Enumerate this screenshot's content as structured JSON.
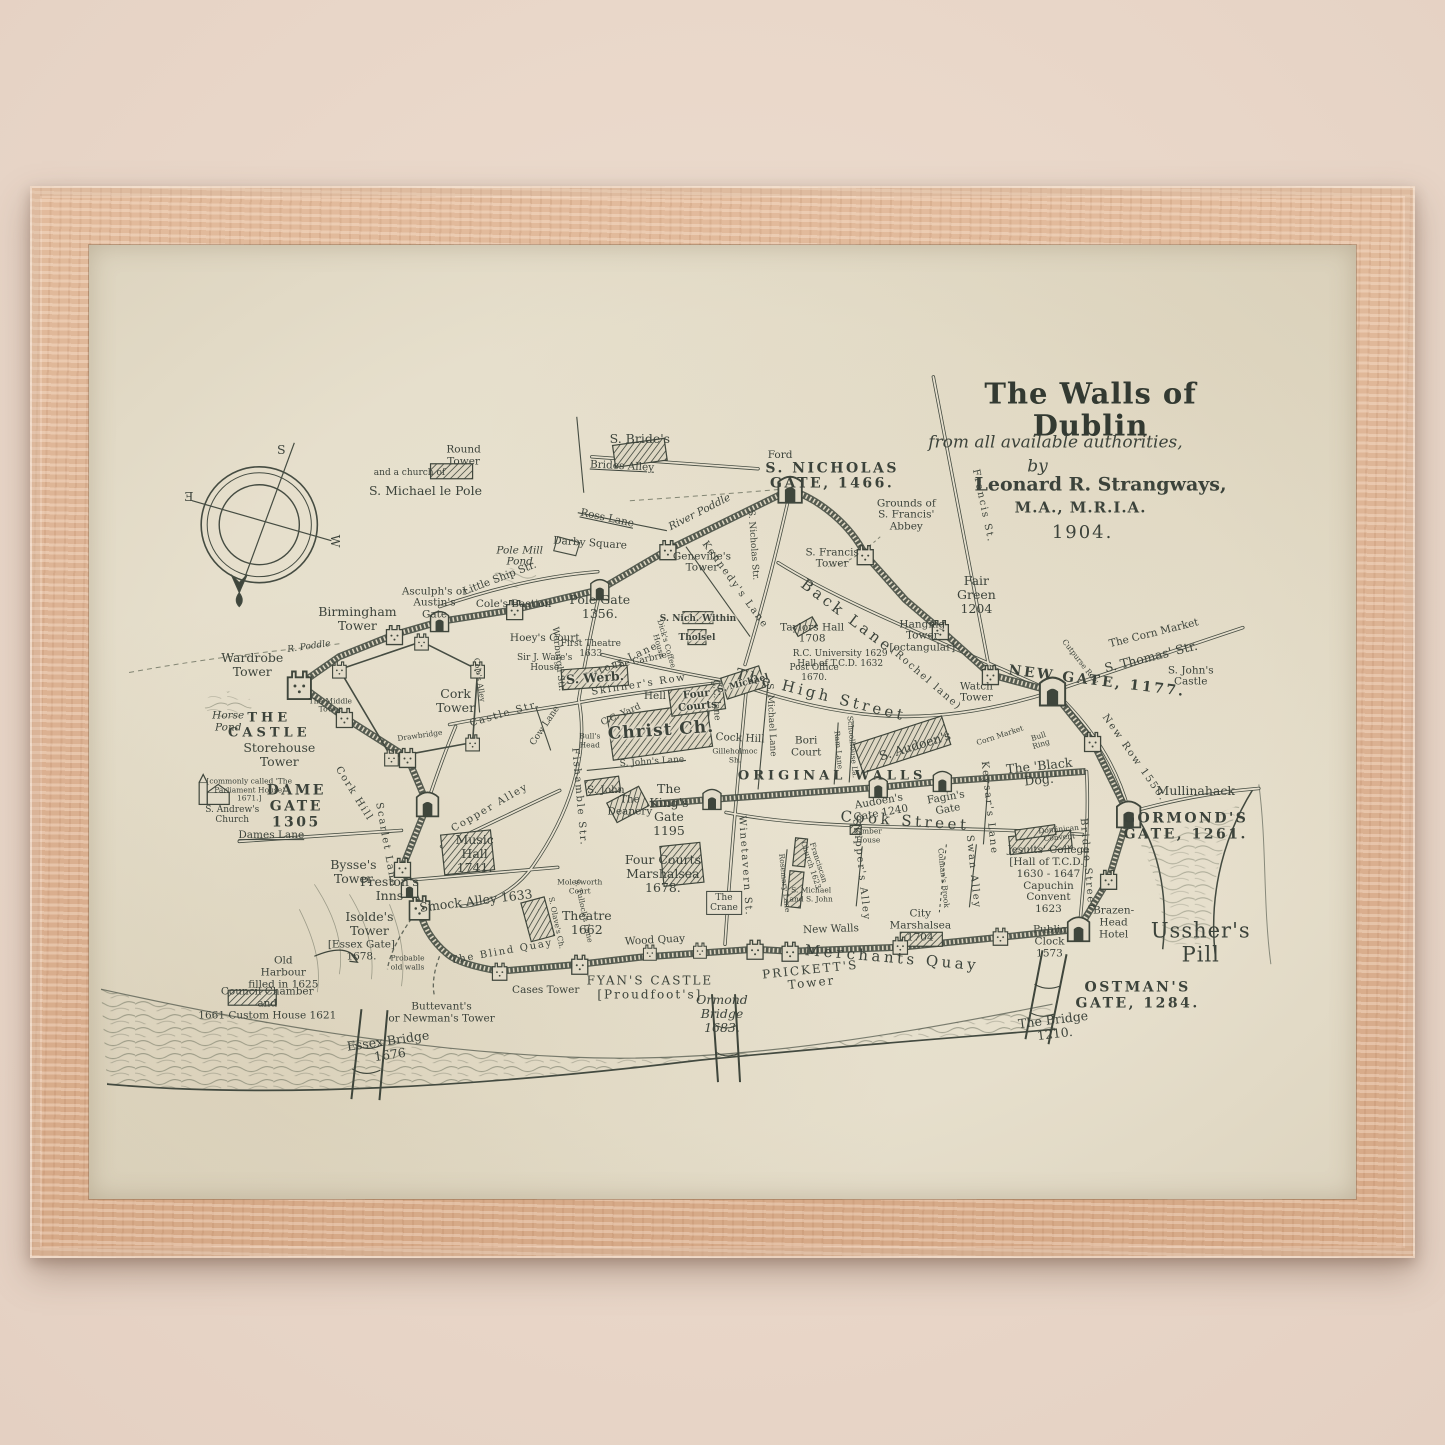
{
  "artwork": {
    "kind": "framed antique map print",
    "frame_color": "#dcb293",
    "paper_color": "#e6dfcc",
    "ink_color": "#3c433b"
  },
  "map": {
    "title": {
      "main": "The Walls of Dublin",
      "sub": "from all available authorities,",
      "by": "by",
      "author": "Leonard R. Strangways,",
      "credentials": "M.A., M.R.I.A.",
      "year": "1904."
    },
    "compass": {
      "letters": [
        "S",
        "Ǝ",
        "W"
      ]
    },
    "labels": [
      {
        "t": "S",
        "x": 192,
        "y": 205,
        "c": "med"
      },
      {
        "t": "Ǝ",
        "x": 100,
        "y": 252,
        "c": "med"
      },
      {
        "t": "W",
        "x": 246,
        "y": 296,
        "c": "med",
        "r": 90
      },
      {
        "t": "Round\nTower",
        "x": 374,
        "y": 211,
        "c": "sm"
      },
      {
        "t": "and a church of",
        "x": 320,
        "y": 228,
        "c": "tiny"
      },
      {
        "t": "S. Michael le Pole",
        "x": 336,
        "y": 246,
        "c": "med"
      },
      {
        "t": "S. Bride's",
        "x": 550,
        "y": 194,
        "c": "med"
      },
      {
        "t": "Brides Alley",
        "x": 532,
        "y": 222,
        "c": "sm ul",
        "r": 3
      },
      {
        "t": "Ross Lane",
        "x": 517,
        "y": 274,
        "c": "sm ul",
        "r": 12
      },
      {
        "t": "River Poddle",
        "x": 610,
        "y": 268,
        "c": "sm water",
        "r": -27
      },
      {
        "t": "Darby Square",
        "x": 500,
        "y": 299,
        "c": "sm",
        "r": 4
      },
      {
        "t": "Geneville's\nTower",
        "x": 612,
        "y": 318,
        "c": "sm"
      },
      {
        "t": "Ford",
        "x": 690,
        "y": 211,
        "c": "sm"
      },
      {
        "t": "S. NICHOLAS\nGATE, 1466.",
        "x": 742,
        "y": 232,
        "c": "gate"
      },
      {
        "t": "Grounds of\nS. Francis'\nAbbey",
        "x": 816,
        "y": 271,
        "c": "sm"
      },
      {
        "t": "S. Francis\nTower",
        "x": 742,
        "y": 314,
        "c": "sm"
      },
      {
        "t": "Fair\nGreen\n1204",
        "x": 886,
        "y": 350,
        "c": "med"
      },
      {
        "t": "Francis St.",
        "x": 893,
        "y": 261,
        "c": "street",
        "r": 78
      },
      {
        "t": "Pole Mill\nPond",
        "x": 430,
        "y": 312,
        "c": "sm water"
      },
      {
        "t": "Little Ship Str.",
        "x": 410,
        "y": 334,
        "c": "sm",
        "r": -21
      },
      {
        "t": "Asculph's or\nAustin's\nGate",
        "x": 345,
        "y": 359,
        "c": "sm"
      },
      {
        "t": "Cole's Bastion",
        "x": 424,
        "y": 360,
        "c": "sm"
      },
      {
        "t": "Birmingham\nTower",
        "x": 268,
        "y": 374,
        "c": "med"
      },
      {
        "t": "R. Poddle",
        "x": 220,
        "y": 402,
        "c": "tiny water",
        "r": -8
      },
      {
        "t": "Pole Gate\n1356.",
        "x": 510,
        "y": 362,
        "c": "med"
      },
      {
        "t": "Hoey's Court",
        "x": 455,
        "y": 394,
        "c": "sm"
      },
      {
        "t": "First Theatre\n1633",
        "x": 501,
        "y": 404,
        "c": "tiny"
      },
      {
        "t": "Sutors Lane",
        "x": 531,
        "y": 417,
        "c": "street",
        "r": -24
      },
      {
        "t": "Sir J. Ware's\nHouse",
        "x": 455,
        "y": 418,
        "c": "tiny"
      },
      {
        "t": "S. Werb.",
        "x": 505,
        "y": 433,
        "c": "med onhatch",
        "r": -4
      },
      {
        "t": "Werburgh Str.",
        "x": 468,
        "y": 414,
        "c": "tiny",
        "r": 84
      },
      {
        "t": "Cole's Alley",
        "x": 389,
        "y": 435,
        "c": "micro",
        "r": 82
      },
      {
        "t": "Cow Lane",
        "x": 455,
        "y": 482,
        "c": "tiny",
        "r": -56
      },
      {
        "t": "Castle Str.",
        "x": 415,
        "y": 469,
        "c": "street",
        "r": -16
      },
      {
        "t": "Drawbridge",
        "x": 330,
        "y": 492,
        "c": "micro",
        "r": -8
      },
      {
        "t": "Wardrobe\nTower",
        "x": 163,
        "y": 420,
        "c": "med"
      },
      {
        "t": "THE\nCASTLE",
        "x": 180,
        "y": 482,
        "c": "caps"
      },
      {
        "t": "The Middle\nTower",
        "x": 241,
        "y": 461,
        "c": "micro"
      },
      {
        "t": "Cork\nTower",
        "x": 366,
        "y": 456,
        "c": "med"
      },
      {
        "t": "Horse\nPond",
        "x": 139,
        "y": 478,
        "c": "sm water"
      },
      {
        "t": "Storehouse\nTower",
        "x": 190,
        "y": 511,
        "c": "med"
      },
      {
        "t": "[commonly called 'The\nParliament House'\n1671.]",
        "x": 160,
        "y": 546,
        "c": "micro"
      },
      {
        "t": "DAME\nGATE\n1305",
        "x": 207,
        "y": 563,
        "c": "gate"
      },
      {
        "t": "S. Andrew's\nChurch",
        "x": 143,
        "y": 571,
        "c": "tiny"
      },
      {
        "t": "Dames Lane",
        "x": 182,
        "y": 592,
        "c": "sm ul"
      },
      {
        "t": "Cork Hill",
        "x": 265,
        "y": 550,
        "c": "street",
        "r": 58
      },
      {
        "t": "Scarlet Lane",
        "x": 297,
        "y": 601,
        "c": "street",
        "r": 80
      },
      {
        "t": "Bysse's\nTower",
        "x": 264,
        "y": 628,
        "c": "med"
      },
      {
        "t": "Isolde's\nTower",
        "x": 280,
        "y": 680,
        "c": "med"
      },
      {
        "t": "[Essex Gate]\n1678.",
        "x": 272,
        "y": 707,
        "c": "sm"
      },
      {
        "t": "Preston's\nInns",
        "x": 300,
        "y": 645,
        "c": "med"
      },
      {
        "t": "Smock Alley 1633",
        "x": 386,
        "y": 657,
        "c": "med",
        "r": -7
      },
      {
        "t": "Copper Alley",
        "x": 400,
        "y": 564,
        "c": "street",
        "r": -30
      },
      {
        "t": "Music\nHall\n1741.",
        "x": 385,
        "y": 610,
        "c": "med"
      },
      {
        "t": "Fishamble Str.",
        "x": 489,
        "y": 553,
        "c": "street",
        "r": 85
      },
      {
        "t": "Molesworth\nCourt",
        "x": 490,
        "y": 643,
        "c": "micro"
      },
      {
        "t": "S. Olave's Ch.",
        "x": 466,
        "y": 679,
        "c": "micro",
        "r": 78
      },
      {
        "t": "S. Tullock's Lane",
        "x": 493,
        "y": 667,
        "c": "micro",
        "r": 78
      },
      {
        "t": "Theatre\n1662",
        "x": 497,
        "y": 679,
        "c": "med"
      },
      {
        "t": "The Blind Quay",
        "x": 412,
        "y": 708,
        "c": "street",
        "r": -10
      },
      {
        "t": "Probable\nold walls",
        "x": 318,
        "y": 719,
        "c": "micro"
      },
      {
        "t": "Cases Tower",
        "x": 456,
        "y": 747,
        "c": "sm"
      },
      {
        "t": "Wood Quay",
        "x": 565,
        "y": 697,
        "c": "sm",
        "r": -3
      },
      {
        "t": "FYAN'S CASTLE\n[Proudfoot's]",
        "x": 560,
        "y": 744,
        "c": "gate2"
      },
      {
        "t": "Ormond\nBridge\n1683.",
        "x": 632,
        "y": 770,
        "c": "med script2"
      },
      {
        "t": "PRICKETT'S\nTower",
        "x": 721,
        "y": 733,
        "c": "gate2",
        "r": -6
      },
      {
        "t": "New Walls",
        "x": 741,
        "y": 686,
        "c": "sm",
        "r": -2
      },
      {
        "t": "Merchants Quay",
        "x": 802,
        "y": 714,
        "c": "street2",
        "r": 5
      },
      {
        "t": "The\nCrane",
        "x": 634,
        "y": 659,
        "c": "tiny boxed"
      },
      {
        "t": "Winetavern St.",
        "x": 655,
        "y": 622,
        "c": "street",
        "r": 86
      },
      {
        "t": "Rosemary Lane",
        "x": 694,
        "y": 639,
        "c": "micro",
        "r": 84
      },
      {
        "t": "S. Michael\nand S. John",
        "x": 721,
        "y": 651,
        "c": "micro"
      },
      {
        "t": "Franciscan\nChurch 1623",
        "x": 724,
        "y": 620,
        "c": "micro",
        "r": 72
      },
      {
        "t": "Skipper's Alley",
        "x": 771,
        "y": 626,
        "c": "street",
        "r": 84
      },
      {
        "t": "Colman's Brook",
        "x": 853,
        "y": 634,
        "c": "micro",
        "r": 84
      },
      {
        "t": "Swan Alley",
        "x": 883,
        "y": 628,
        "c": "street",
        "r": 84
      },
      {
        "t": "City\nMarshalsea\n1704",
        "x": 830,
        "y": 682,
        "c": "sm"
      },
      {
        "t": "Cook Street",
        "x": 815,
        "y": 577,
        "c": "street2",
        "r": 4
      },
      {
        "t": "Audoen's\nGate 1240",
        "x": 790,
        "y": 564,
        "c": "sm",
        "r": -10
      },
      {
        "t": "Fagin's\nGate",
        "x": 857,
        "y": 560,
        "c": "sm",
        "r": -10
      },
      {
        "t": "Timber\nHouse",
        "x": 778,
        "y": 592,
        "c": "micro"
      },
      {
        "t": "S. Audoen's",
        "x": 825,
        "y": 502,
        "c": "med",
        "r": -17
      },
      {
        "t": "ORIGINAL WALLS",
        "x": 742,
        "y": 533,
        "c": "caps"
      },
      {
        "t": "Bori\nCourt",
        "x": 716,
        "y": 503,
        "c": "sm"
      },
      {
        "t": "Ram Lane",
        "x": 748,
        "y": 506,
        "c": "micro",
        "r": 85
      },
      {
        "t": "Schoolhouse La.",
        "x": 762,
        "y": 503,
        "c": "micro",
        "r": 85
      },
      {
        "t": "S. Michael Lane",
        "x": 681,
        "y": 475,
        "c": "tiny",
        "r": 87
      },
      {
        "t": "S. Michael",
        "x": 653,
        "y": 439,
        "c": "tiny onhatch",
        "r": -15
      },
      {
        "t": "Cock Hill",
        "x": 650,
        "y": 495,
        "c": "sm",
        "r": 3
      },
      {
        "t": "Gilleholmoc\nSh.",
        "x": 645,
        "y": 512,
        "c": "micro"
      },
      {
        "t": "The  High  Street",
        "x": 731,
        "y": 450,
        "c": "street2",
        "r": 14
      },
      {
        "t": "Back Lane",
        "x": 757,
        "y": 371,
        "c": "street2",
        "r": 37
      },
      {
        "t": "(Rochel lane)",
        "x": 836,
        "y": 434,
        "c": "street",
        "r": 41
      },
      {
        "t": "Taylors Hall\n1708",
        "x": 722,
        "y": 389,
        "c": "sm"
      },
      {
        "t": "R.C. University 1629\nHall of T.C.D. 1632",
        "x": 750,
        "y": 414,
        "c": "tiny"
      },
      {
        "t": "Post Office\n1670.",
        "x": 724,
        "y": 428,
        "c": "tiny"
      },
      {
        "t": "Hanging\nTower\n[octangular]",
        "x": 832,
        "y": 392,
        "c": "sm"
      },
      {
        "t": "Watch\nTower",
        "x": 886,
        "y": 448,
        "c": "sm"
      },
      {
        "t": "NEW GATE, 1177.",
        "x": 1006,
        "y": 437,
        "c": "gate",
        "r": 7
      },
      {
        "t": "The Corn Market",
        "x": 1063,
        "y": 389,
        "c": "sm",
        "r": -14
      },
      {
        "t": "S. Thomas' Str.",
        "x": 1060,
        "y": 412,
        "c": "med",
        "r": -14
      },
      {
        "t": "Cutpurse Row",
        "x": 989,
        "y": 417,
        "c": "micro",
        "r": 52
      },
      {
        "t": "S. John's\nCastle",
        "x": 1100,
        "y": 432,
        "c": "sm"
      },
      {
        "t": "New Row 1550.",
        "x": 1043,
        "y": 514,
        "c": "street",
        "r": 55
      },
      {
        "t": "The 'Black\nDog.'",
        "x": 949,
        "y": 529,
        "c": "med",
        "r": -6
      },
      {
        "t": "Corn Market",
        "x": 910,
        "y": 492,
        "c": "micro",
        "r": -18
      },
      {
        "t": "Bull\nRing",
        "x": 949,
        "y": 497,
        "c": "micro",
        "r": -18
      },
      {
        "t": "Keysar's Lane",
        "x": 899,
        "y": 564,
        "c": "street",
        "r": 84
      },
      {
        "t": "Mullinahack",
        "x": 1105,
        "y": 547,
        "c": "med"
      },
      {
        "t": "GORMOND'S\nGATE, 1261.",
        "x": 1095,
        "y": 583,
        "c": "gate"
      },
      {
        "t": "Dominican\nConvent",
        "x": 968,
        "y": 590,
        "c": "micro",
        "r": -5
      },
      {
        "t": "Jesuits' College\n[Hall of T.C.D.]\n1630 - 1647\nCapuchin\nConvent\n1623",
        "x": 958,
        "y": 636,
        "c": "sm"
      },
      {
        "t": "Bridge Street",
        "x": 996,
        "y": 620,
        "c": "street",
        "r": 85
      },
      {
        "t": "Brazen-\nHead\nHotel",
        "x": 1023,
        "y": 679,
        "c": "sm"
      },
      {
        "t": "Public\nClock\n1573",
        "x": 959,
        "y": 698,
        "c": "sm"
      },
      {
        "t": "Ussher's\nPill",
        "x": 1110,
        "y": 699,
        "c": "big2"
      },
      {
        "t": "OSTMAN'S\nGATE, 1284.",
        "x": 1047,
        "y": 752,
        "c": "gate"
      },
      {
        "t": "The Bridge\n1210.",
        "x": 963,
        "y": 783,
        "c": "med",
        "r": -7
      },
      {
        "t": "Essex Bridge\n1676",
        "x": 300,
        "y": 804,
        "c": "med",
        "r": -8
      },
      {
        "t": "Old\nHarbour\nfilled in 1625",
        "x": 194,
        "y": 729,
        "c": "sm"
      },
      {
        "t": "Council Chamber\nand\n1661 Custom House 1621",
        "x": 178,
        "y": 760,
        "c": "sm"
      },
      {
        "t": "Buttevant's\nor Newman's Tower",
        "x": 352,
        "y": 769,
        "c": "sm"
      },
      {
        "t": "Hell",
        "x": 565,
        "y": 452,
        "c": "sm"
      },
      {
        "t": "Four\nCourts",
        "x": 607,
        "y": 456,
        "c": "sm onhatch",
        "r": -6
      },
      {
        "t": "C.C. Yard",
        "x": 531,
        "y": 470,
        "c": "tiny",
        "r": -24
      },
      {
        "t": "Christ Ch.",
        "x": 571,
        "y": 487,
        "c": "big3 onhatch",
        "r": -4
      },
      {
        "t": "Bull's\nHead",
        "x": 500,
        "y": 497,
        "c": "micro"
      },
      {
        "t": "S. John's Lane",
        "x": 562,
        "y": 518,
        "c": "tiny",
        "r": -4
      },
      {
        "t": "S. John",
        "x": 516,
        "y": 547,
        "c": "sm"
      },
      {
        "t": "The\nDeanery",
        "x": 540,
        "y": 562,
        "c": "sm"
      },
      {
        "t": "The\nKing's\nGate\n1195",
        "x": 579,
        "y": 566,
        "c": "med"
      },
      {
        "t": "Four Courts\nMarshalsea\n1678.",
        "x": 573,
        "y": 630,
        "c": "med"
      },
      {
        "t": "Skinner's Row",
        "x": 549,
        "y": 440,
        "c": "street",
        "r": -9
      },
      {
        "t": "Kennedy's Lane",
        "x": 645,
        "y": 340,
        "c": "street",
        "r": 54
      },
      {
        "t": "S. Nicholas Str.",
        "x": 663,
        "y": 300,
        "c": "tiny",
        "r": 86
      },
      {
        "t": "S. Nich. Within",
        "x": 608,
        "y": 374,
        "c": "tiny onhatch"
      },
      {
        "t": "Tholsel",
        "x": 607,
        "y": 393,
        "c": "tiny onhatch"
      },
      {
        "t": "The Carbrie",
        "x": 550,
        "y": 416,
        "c": "tiny",
        "r": -12
      },
      {
        "t": "Dick's Coffee\nHouse",
        "x": 572,
        "y": 400,
        "c": "micro",
        "r": 74
      },
      {
        "t": "C.C. lane",
        "x": 626,
        "y": 455,
        "c": "tiny",
        "r": 88
      }
    ]
  }
}
